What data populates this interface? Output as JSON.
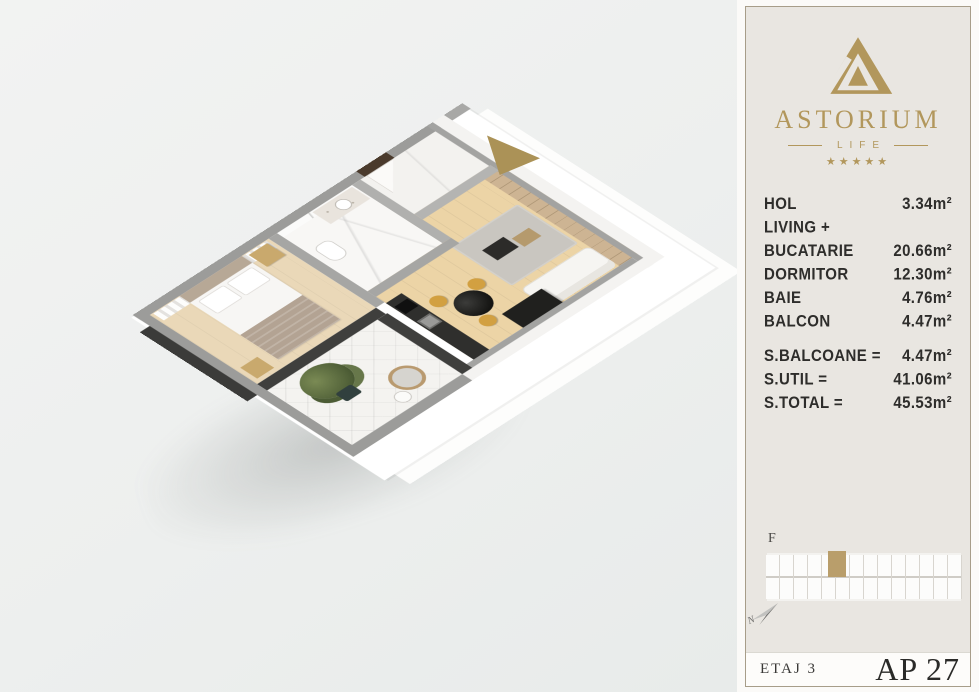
{
  "colors": {
    "brand_gold": "#b2975c",
    "entrance_arrow_gold": "#ab9257",
    "panel_beige": "#e9e6e1",
    "panel_white": "#fbfaf8",
    "border_tan": "#a79d89",
    "text_dark": "#2e2d2b",
    "wall_gray": "#9c9c9a",
    "wall_dark": "#3b3b39",
    "wood_floor": "#ecd4a6",
    "wardrobe_wood": "#cdb493",
    "chair_mustard": "#d2a041",
    "locator_highlight": "#b99e6b"
  },
  "panel": {
    "logo": {
      "brand": "ASTORIUM",
      "subtitle": "LIFE",
      "stars": "★★★★★"
    },
    "rooms": [
      {
        "label": "HOL",
        "value": "3.34m²"
      },
      {
        "label": "LIVING +",
        "value": ""
      },
      {
        "label": "BUCATARIE",
        "value": "20.66m²"
      },
      {
        "label": "DORMITOR",
        "value": "12.30m²"
      },
      {
        "label": "BAIE",
        "value": "4.76m²"
      },
      {
        "label": "BALCON",
        "value": "4.47m²"
      }
    ],
    "totals": [
      {
        "label": "S.BALCOANE =",
        "value": "4.47m²"
      },
      {
        "label": "S.UTIL =",
        "value": "41.06m²"
      },
      {
        "label": "S.TOTAL =",
        "value": "45.53m²"
      }
    ],
    "locator": {
      "section_label": "F",
      "compass_letter": "N"
    },
    "footer": {
      "floor_label": "ETAJ 3",
      "apartment_label": "AP 27"
    }
  }
}
